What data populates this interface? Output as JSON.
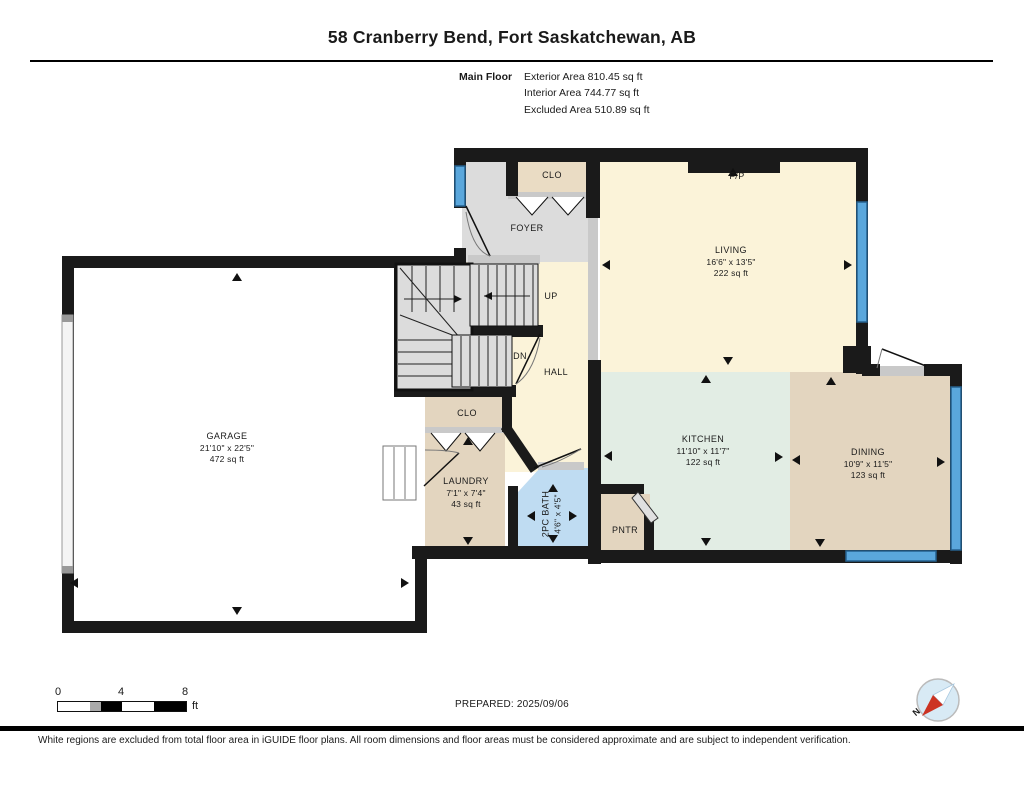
{
  "header": {
    "title": "58 Cranberry Bend, Fort Saskatchewan, AB",
    "floor_label": "Main Floor",
    "area_lines": [
      "Exterior Area 810.45 sq ft",
      "Interior Area 744.77 sq ft",
      "Excluded Area 510.89 sq ft"
    ]
  },
  "rooms": {
    "garage": {
      "name": "GARAGE",
      "dims": "21'10\" x 22'5\"",
      "area": "472 sq ft"
    },
    "living": {
      "name": "LIVING",
      "dims": "16'6\" x 13'5\"",
      "area": "222 sq ft"
    },
    "kitchen": {
      "name": "KITCHEN",
      "dims": "11'10\" x 11'7\"",
      "area": "122 sq ft"
    },
    "dining": {
      "name": "DINING",
      "dims": "10'9\" x 11'5\"",
      "area": "123 sq ft"
    },
    "laundry": {
      "name": "LAUNDRY",
      "dims": "7'1\" x 7'4\"",
      "area": "43 sq ft"
    },
    "bath": {
      "name": "2PC BATH",
      "dims": "4'6\" x 4'5\""
    },
    "foyer": {
      "name": "FOYER"
    },
    "hall": {
      "name": "HALL"
    },
    "closet_foyer": {
      "name": "CLO"
    },
    "closet_laundry": {
      "name": "CLO"
    },
    "pantry": {
      "name": "PNTR"
    },
    "fireplace": {
      "name": "F/P"
    },
    "stairs_up": {
      "name": "UP"
    },
    "stairs_down": {
      "name": "DN"
    }
  },
  "footer": {
    "scale_ticks": [
      "0",
      "4",
      "8"
    ],
    "scale_unit": "ft",
    "prepared": "PREPARED: 2025/09/06",
    "compass_north": "N",
    "disclaimer": "White regions are excluded from total floor area in iGUIDE floor plans. All room dimensions and floor areas must be considered approximate and are subject to independent verification."
  },
  "colors": {
    "wall": "#1a1a1a",
    "living_cream": "#FBF3D9",
    "kitchen_mint": "#E2EDE4",
    "tan": "#E3D5BF",
    "bath_blue": "#BFDCF2",
    "foyer_gray": "#DCDCDC",
    "stair_gray": "#DCDCDC",
    "window_blue": "#5AA7DC",
    "compass_red": "#CC3322"
  }
}
